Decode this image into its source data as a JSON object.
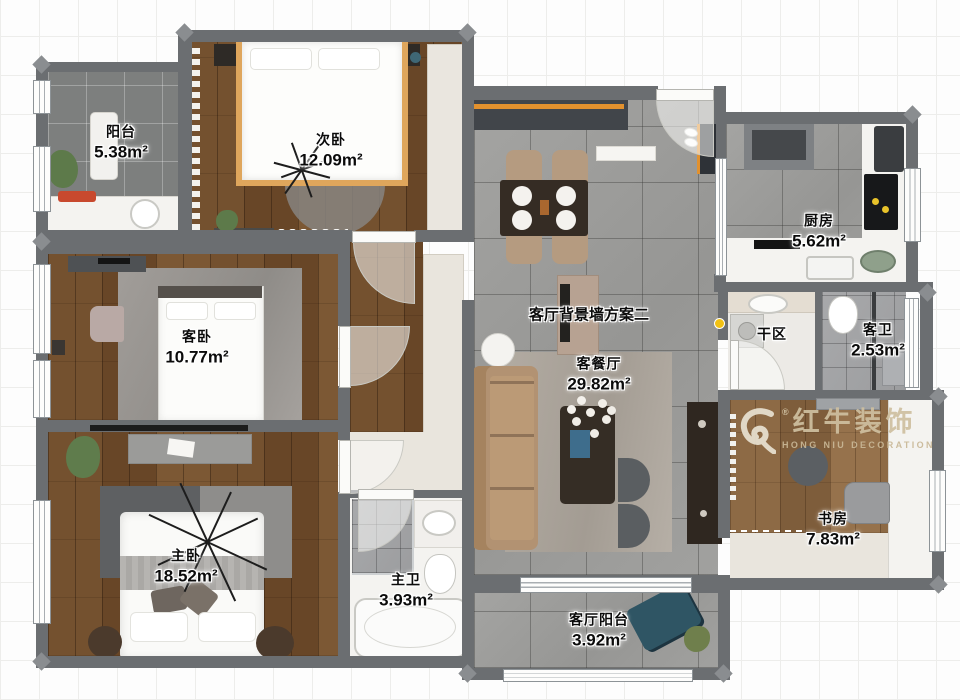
{
  "rooms": [
    {
      "name": "阳台",
      "area": "5.38m²"
    },
    {
      "name": "次卧",
      "area": "12.09m²"
    },
    {
      "name": "客卧",
      "area": "10.77m²"
    },
    {
      "name": "主卧",
      "area": "18.52m²"
    },
    {
      "name": "客餐厅",
      "area": "29.82m²"
    },
    {
      "name": "厨房",
      "area": "5.62m²"
    },
    {
      "name": "干区",
      "area": ""
    },
    {
      "name": "客卫",
      "area": "2.53m²"
    },
    {
      "name": "书房",
      "area": "7.83m²"
    },
    {
      "name": "主卫",
      "area": "3.93m²"
    },
    {
      "name": "客厅阳台",
      "area": "3.92m²"
    }
  ],
  "annotations": {
    "tv_wall_plan": "客厅背景墙方案二"
  },
  "watermark": {
    "cn": "红牛装饰",
    "en": "HONG NIU DECORATION",
    "reg": "®"
  },
  "colors": {
    "wall": "#6b6e71",
    "accent_orange": "#e2912e",
    "sofa_tan": "#b29272",
    "lounge_teal": "#2f5564",
    "yellow_marker": "#f2c113"
  }
}
